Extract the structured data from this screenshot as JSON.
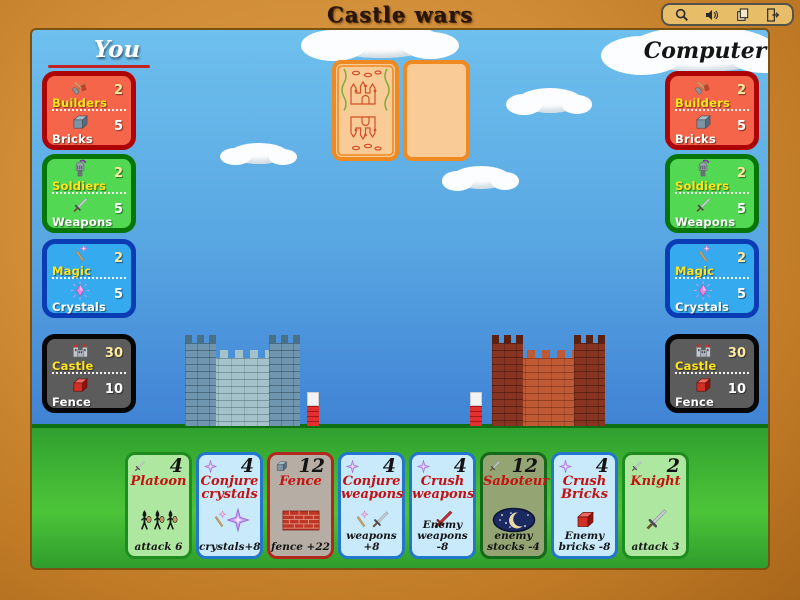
{
  "window": {
    "title": "Castle wars",
    "toolbar": [
      {
        "label": "zoom",
        "icon": "magnifier-icon"
      },
      {
        "label": "sound",
        "icon": "speaker-icon"
      },
      {
        "label": "copy",
        "icon": "pages-icon"
      },
      {
        "label": "quit",
        "icon": "exit-door-icon"
      }
    ]
  },
  "players": {
    "you": {
      "label": "You",
      "panels": [
        {
          "name": "builders-bricks",
          "rows": [
            {
              "label": "Builders",
              "value": 2,
              "icon": "tools-icon"
            },
            {
              "label": "Bricks",
              "value": 5,
              "icon": "brick-icon"
            }
          ]
        },
        {
          "name": "soldiers-weapons",
          "rows": [
            {
              "label": "Soldiers",
              "value": 2,
              "icon": "soldier-icon"
            },
            {
              "label": "Weapons",
              "value": 5,
              "icon": "sword-icon"
            }
          ]
        },
        {
          "name": "magic-crystals",
          "rows": [
            {
              "label": "Magic",
              "value": 2,
              "icon": "wand-icon"
            },
            {
              "label": "Crystals",
              "value": 5,
              "icon": "crystal-icon"
            }
          ]
        },
        {
          "name": "castle-fence",
          "rows": [
            {
              "label": "Castle",
              "value": 30,
              "icon": "castle-icon"
            },
            {
              "label": "Fence",
              "value": 10,
              "icon": "red-brick-icon"
            }
          ]
        }
      ]
    },
    "computer": {
      "label": "Computer",
      "panels": [
        {
          "name": "builders-bricks",
          "rows": [
            {
              "label": "Builders",
              "value": 2,
              "icon": "tools-icon"
            },
            {
              "label": "Bricks",
              "value": 5,
              "icon": "brick-icon"
            }
          ]
        },
        {
          "name": "soldiers-weapons",
          "rows": [
            {
              "label": "Soldiers",
              "value": 2,
              "icon": "soldier-icon"
            },
            {
              "label": "Weapons",
              "value": 5,
              "icon": "sword-icon"
            }
          ]
        },
        {
          "name": "magic-crystals",
          "rows": [
            {
              "label": "Magic",
              "value": 2,
              "icon": "wand-icon"
            },
            {
              "label": "Crystals",
              "value": 5,
              "icon": "crystal-icon"
            }
          ]
        },
        {
          "name": "castle-fence",
          "rows": [
            {
              "label": "Castle",
              "value": 30,
              "icon": "castle-icon"
            },
            {
              "label": "Fence",
              "value": 10,
              "icon": "red-brick-icon"
            }
          ]
        }
      ]
    }
  },
  "board": {
    "deck": {
      "back_card": "card-back",
      "empty_slot": "blank-card"
    },
    "player_castle": {
      "color": "blue",
      "fence_post": "white-red"
    },
    "computer_castle": {
      "color": "red",
      "fence_post": "white-red"
    }
  },
  "hand": {
    "cards": [
      {
        "title": "Platoon",
        "cost": 4,
        "cost_type": "weapons",
        "effect": "attack 6",
        "variant": "green"
      },
      {
        "title": "Conjure\ncrystals",
        "cost": 4,
        "cost_type": "crystals",
        "effect": "crystals+8",
        "variant": "blue"
      },
      {
        "title": "Fence",
        "cost": 12,
        "cost_type": "bricks",
        "effect": "fence +22",
        "variant": "gray"
      },
      {
        "title": "Conjure\nweapons",
        "cost": 4,
        "cost_type": "crystals",
        "effect": "weapons +8",
        "variant": "blue"
      },
      {
        "title": "Crush\nweapons",
        "cost": 4,
        "cost_type": "crystals",
        "effect": "Enemy\nweapons -8",
        "variant": "blue"
      },
      {
        "title": "Saboteur",
        "cost": 12,
        "cost_type": "weapons",
        "effect": "enemy\nstocks -4",
        "variant": "olive"
      },
      {
        "title": "Crush\nBricks",
        "cost": 4,
        "cost_type": "crystals",
        "effect": "Enemy\nbricks -8",
        "variant": "blue"
      },
      {
        "title": "Knight",
        "cost": 2,
        "cost_type": "weapons",
        "effect": "attack 3",
        "variant": "green"
      }
    ]
  },
  "colors": {
    "frame": "#d08c36",
    "sky_top": "#6ec0ee",
    "sky_bottom": "#3a74c8",
    "grass": "#3db432",
    "panel_red": "#f4654a",
    "panel_green": "#52d852",
    "panel_blue": "#35aaee",
    "panel_black": "#5c5c5c",
    "card_green": "#aee8a0",
    "card_blue": "#c8eafb",
    "card_gray": "#b6aea4",
    "card_olive": "#94a573",
    "card_title_red": "#c41111",
    "label_yellow": "#ffe41e",
    "underline_red": "#c32222",
    "deck_orange": "#ef8921"
  }
}
